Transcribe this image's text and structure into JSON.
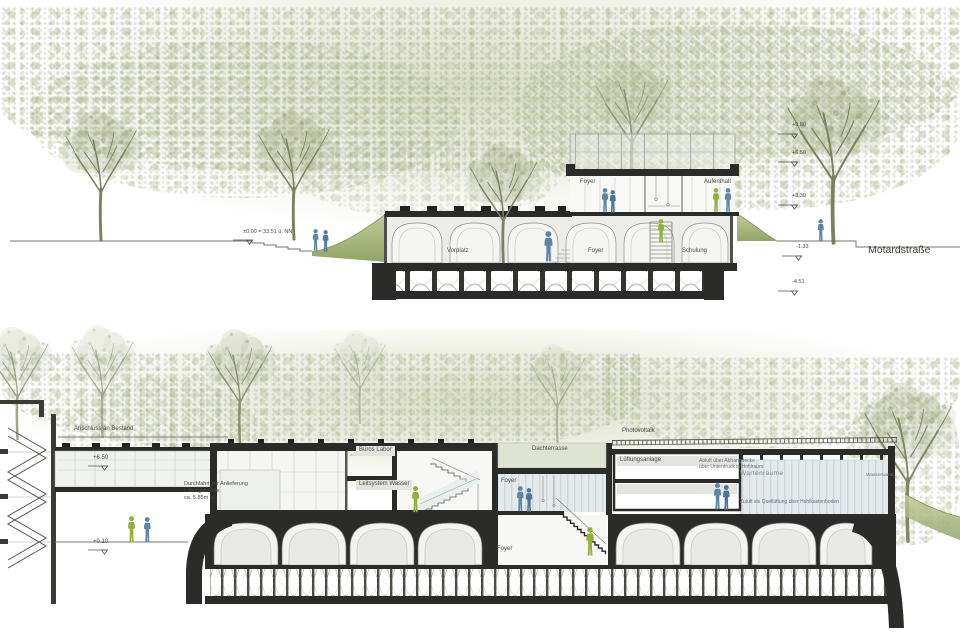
{
  "colors": {
    "person_blue": "#5b86a6",
    "person_green": "#93b03a",
    "ink": "#2b2b29",
    "foliage_base": "#dce1c9"
  },
  "upper_section": {
    "datum_label": "±0.00 = 33.51 ü. NN",
    "street_label": "Motardstraße",
    "levels": [
      {
        "label": "+9.80"
      },
      {
        "label": "+6.50"
      },
      {
        "label": "+3.30"
      },
      {
        "label": "-1.33"
      },
      {
        "label": "-4.51"
      }
    ],
    "rooms": {
      "foyer_upper": "Foyer",
      "aufenthalt": "Aufenthalt",
      "vorplatz": "Vorplatz",
      "foyer_hall": "Foyer",
      "schulung": "Schulung"
    }
  },
  "lower_section": {
    "anschluss_label": "Anschluss an Bestand",
    "level_bridge": "+6.50",
    "level_ground": "+0.10",
    "durchfahrt_note": [
      "Durchfahrt zur Anlieferung",
      "Laborgebäude",
      "ca. 5.85m l.L."
    ],
    "rooms": {
      "bueros": "Büros",
      "labor": "Labor",
      "leitsystem": "Leitsystem",
      "wasser": "Wasser",
      "dachterrasse": "Dachterrasse",
      "foyer_upper": "Foyer",
      "foyer_lower": "Foyer",
      "wartenraeume": "Wartenräume",
      "lueftungsanlage": "Lüftungsanlage"
    },
    "annotations": {
      "photovoltaik": "Photovoltaik",
      "abluft": [
        "Abluft über Abhangdecke",
        "über Unterdruck in Hohlraum"
      ],
      "zuluft": "Zuluft als Quellüftung über Hohlkastenboden",
      "wasserwand": "Wasserwand"
    }
  }
}
